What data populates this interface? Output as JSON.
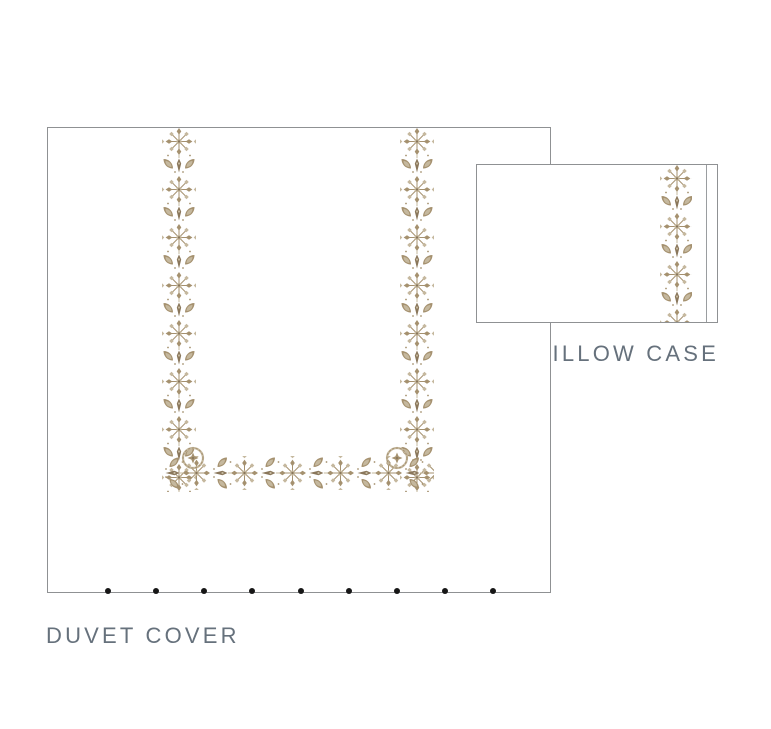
{
  "products": {
    "duvet": {
      "label": "DUVET COVER",
      "button_count": 9
    },
    "pillow": {
      "label": "PILLOW CASE"
    }
  },
  "colors": {
    "outline": "#8f9193",
    "embroidery_main": "#a5916f",
    "embroidery_light": "#c5b89e",
    "embroidery_dark": "#8a775b",
    "label_text": "#66717c",
    "button_dot": "#161616",
    "seam_line": "#9a9da0",
    "bg": "#ffffff"
  }
}
